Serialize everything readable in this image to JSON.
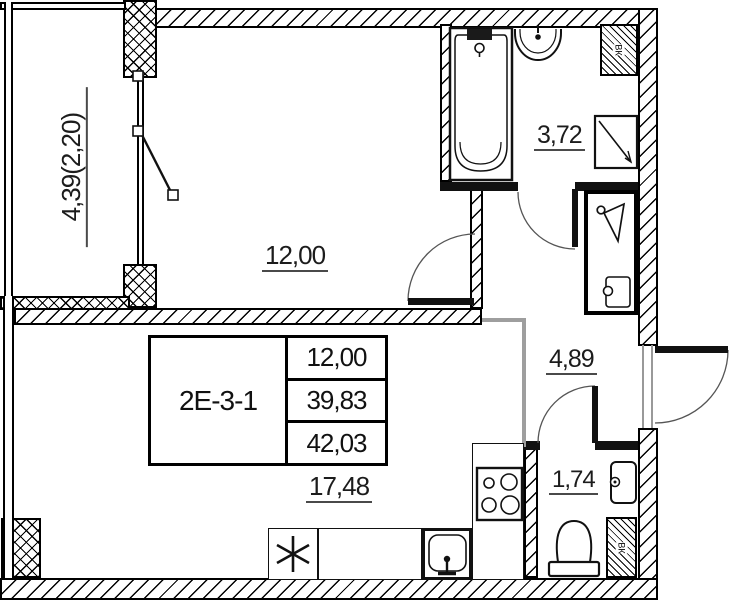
{
  "plan": {
    "unit_table": {
      "unit_label": "2Е-3-1",
      "rows": [
        "12,00",
        "39,83",
        "42,03"
      ]
    },
    "labels": {
      "balcony": "4,39(2,20)",
      "room": "12,00",
      "bathroom": "3,72",
      "hallway": "4,89",
      "kitchen_living": "17,48",
      "wc": "1,74"
    },
    "vent_label": "ВК",
    "colors": {
      "wall": "#111111",
      "zone_boundary": "#9e9e9e",
      "label_text": "#1c1c1c"
    },
    "icons": [
      "bathtub",
      "wash-basin",
      "washing-machine",
      "cooktop",
      "kitchen-sink",
      "asterisk-symbol",
      "toilet",
      "wc-basin",
      "hanger-icon",
      "bag-icon",
      "door-swing-arc",
      "vent-shaft"
    ]
  }
}
